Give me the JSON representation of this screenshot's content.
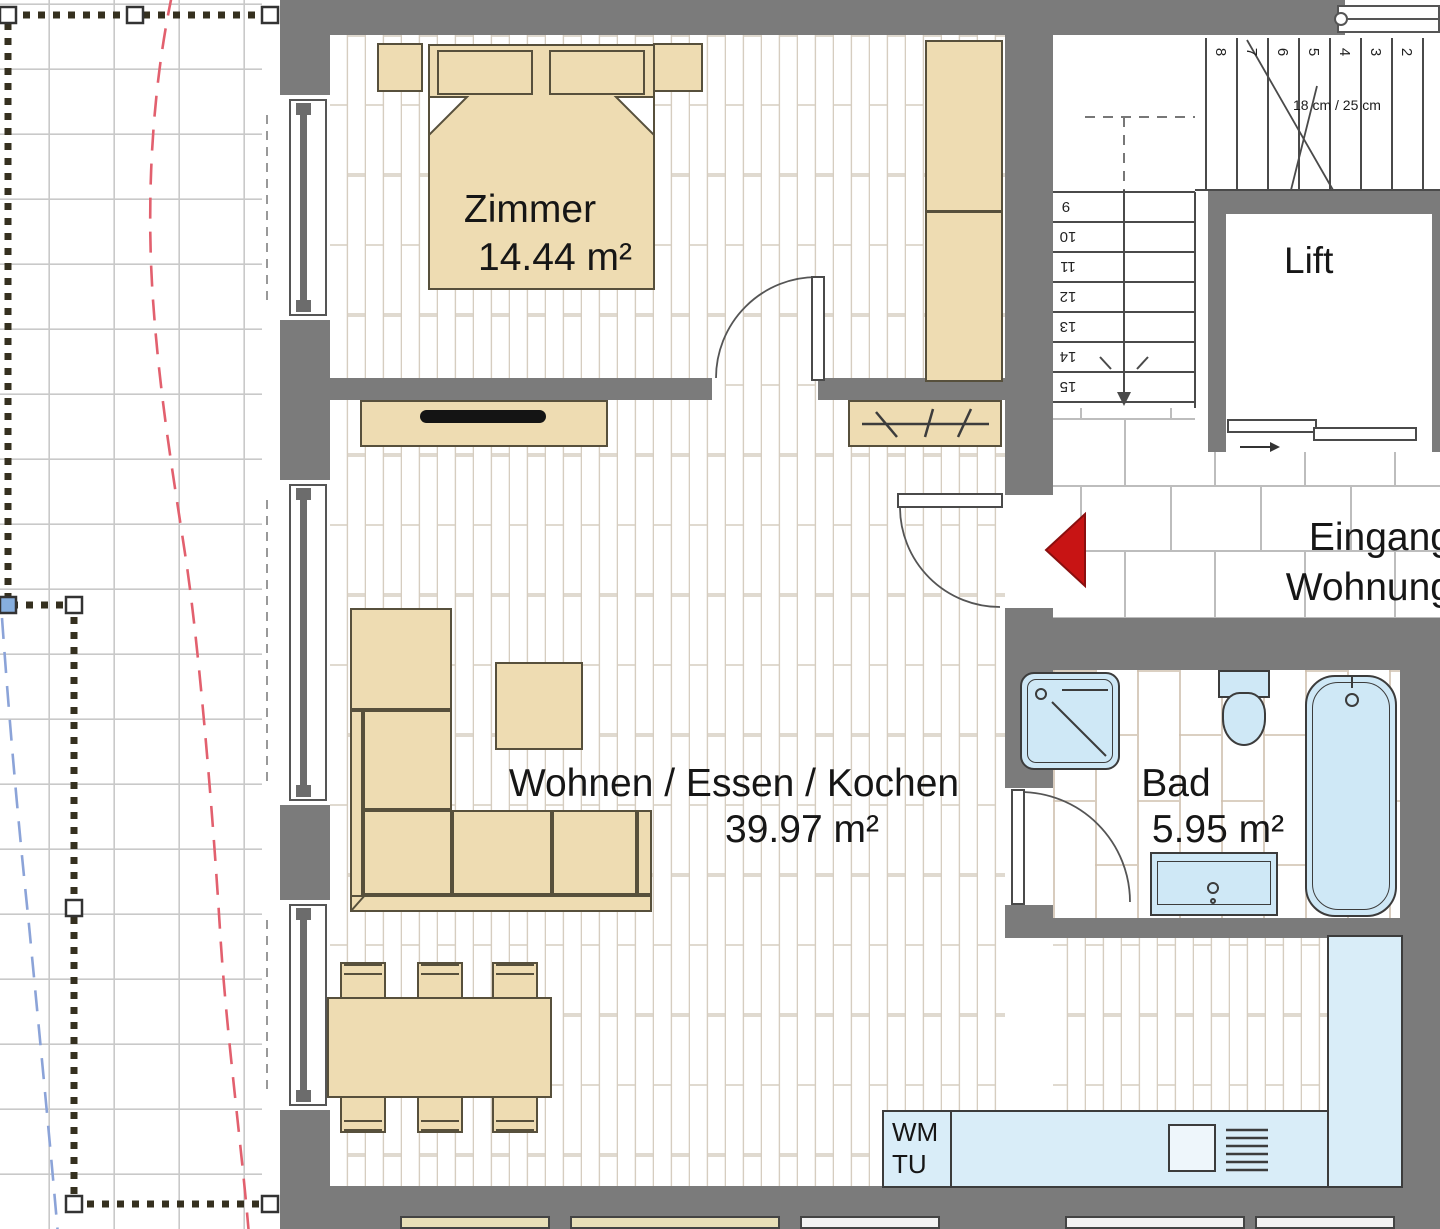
{
  "rooms": {
    "zimmer": {
      "name": "Zimmer",
      "area": "14.44 m²"
    },
    "wohnen": {
      "name": "Wohnen / Essen / Kochen",
      "area": "39.97 m²"
    },
    "bad": {
      "name": "Bad",
      "area": "5.95 m²"
    },
    "lift": {
      "name": "Lift"
    },
    "eingang": {
      "line1": "Eingang",
      "line2": "Wohnung"
    }
  },
  "kitchen": {
    "wm": "WM",
    "tu": "TU"
  },
  "stairs": {
    "annotation": "18 cm / 25 cm",
    "upper_numbers": [
      "8",
      "7",
      "6",
      "5",
      "4",
      "3",
      "2"
    ],
    "lower_numbers": [
      "9",
      "10",
      "11",
      "12",
      "13",
      "14",
      "15"
    ]
  },
  "icons": {
    "entrance_arrow": "red-entrance-direction-arrow",
    "stair_direction_arrow": "stair-walkline-arrow",
    "lift_door_arrow": "lift-door-slide-arrow",
    "shower": "shower-symbol",
    "coat_rack": "coat-rack-hooks"
  },
  "colors": {
    "wall": "#7b7b7b",
    "furniture": "#eedcb2",
    "fixture_blue": "#d9edf8",
    "entrance_arrow_red": "#c81414",
    "dashed_red": "#e2606e",
    "dashed_blue": "#8ba3d8"
  }
}
